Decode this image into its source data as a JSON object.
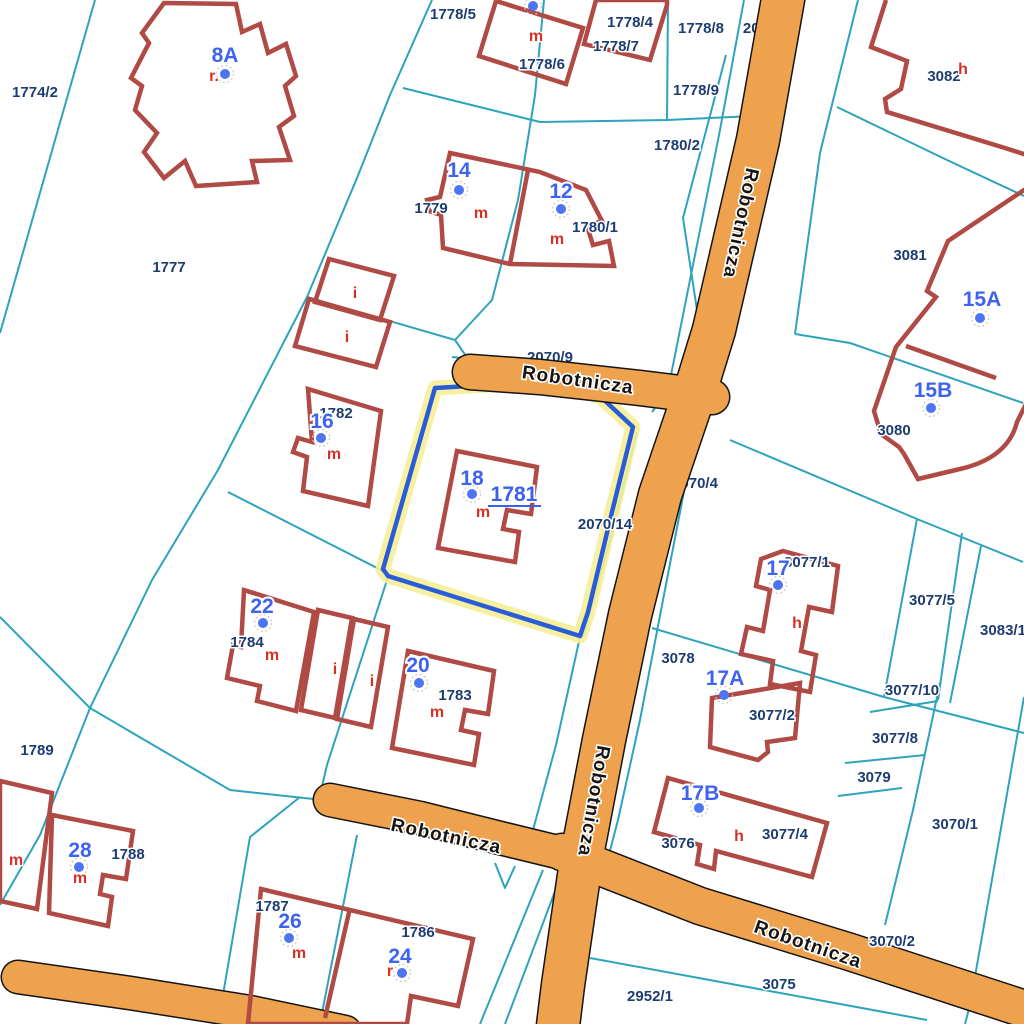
{
  "map": {
    "colors": {
      "background": "#FFFFFF",
      "parcel_line": "#2EA3BC",
      "parcel_label": "#1C3C72",
      "building_outline": "#B04A44",
      "building_number": "#3E63F0",
      "address_point": "#4D74F2",
      "type_letter": "#D53227",
      "road_fill": "#EFA24E",
      "road_casing": "#141414",
      "selection_stroke": "#2B5CD8",
      "selection_halo": "#F5EE96"
    },
    "parcel_lines": [
      [
        95,
        0,
        0,
        333
      ],
      [
        432,
        0,
        390,
        95,
        357,
        178,
        307,
        297
      ],
      [
        403,
        88,
        540,
        122,
        667,
        120,
        753,
        116
      ],
      [
        668,
        0,
        667,
        120
      ],
      [
        726,
        55,
        683,
        218,
        697,
        310
      ],
      [
        307,
        297,
        455,
        340
      ],
      [
        455,
        340,
        492,
        300,
        518,
        200,
        535,
        95,
        544,
        0
      ],
      [
        455,
        340,
        466,
        356
      ],
      [
        307,
        297,
        218,
        470,
        152,
        580,
        90,
        708,
        40,
        835,
        0,
        905
      ],
      [
        0,
        617,
        90,
        708
      ],
      [
        90,
        708,
        230,
        790,
        332,
        801
      ],
      [
        388,
        577,
        327,
        765,
        320,
        795
      ],
      [
        580,
        637,
        556,
        745,
        533,
        830
      ],
      [
        744,
        0,
        720,
        130,
        668,
        390,
        652,
        412
      ],
      [
        858,
        0,
        820,
        153,
        795,
        334
      ],
      [
        795,
        334,
        850,
        343,
        1023,
        403
      ],
      [
        837,
        107,
        947,
        160,
        1024,
        196
      ],
      [
        637,
        432,
        610,
        540,
        583,
        637
      ],
      [
        692,
        450,
        663,
        600,
        640,
        720,
        618,
        820,
        607,
        862
      ],
      [
        730,
        440,
        917,
        519,
        1023,
        562
      ],
      [
        917,
        519,
        884,
        697
      ],
      [
        962,
        533,
        938,
        700
      ],
      [
        981,
        546,
        950,
        703
      ],
      [
        652,
        628,
        884,
        697,
        1024,
        733
      ],
      [
        940,
        683,
        913,
        810,
        885,
        925
      ],
      [
        870,
        712,
        938,
        701
      ],
      [
        845,
        763,
        925,
        755
      ],
      [
        838,
        796,
        902,
        788
      ],
      [
        1024,
        697,
        970,
        1005,
        965,
        1024
      ],
      [
        590,
        958,
        927,
        1020
      ],
      [
        543,
        870,
        480,
        1024
      ],
      [
        560,
        878,
        505,
        1024
      ],
      [
        300,
        797,
        250,
        837,
        218,
        1024
      ],
      [
        357,
        835,
        322,
        1013
      ],
      [
        452,
        357,
        700,
        382
      ],
      [
        333,
        790,
        450,
        812,
        565,
        842
      ],
      [
        495,
        863,
        505,
        888,
        515,
        866
      ],
      [
        228,
        492,
        383,
        571
      ]
    ],
    "roads": {
      "segments": [
        {
          "w": 42,
          "pts": [
            785,
            -12,
            758,
            140,
            714,
            330,
            694,
            395,
            660,
            495,
            630,
            615,
            604,
            740,
            582,
            855,
            563,
            985,
            557,
            1034
          ]
        },
        {
          "w": 34,
          "pts": [
            470,
            372,
            540,
            377,
            640,
            388,
            712,
            397
          ]
        },
        {
          "w": 32,
          "pts": [
            330,
            800,
            420,
            818,
            500,
            838,
            578,
            857
          ]
        },
        {
          "w": 36,
          "pts": [
            562,
            852,
            700,
            906,
            850,
            952,
            1040,
            1014
          ]
        },
        {
          "w": 32,
          "pts": [
            18,
            977,
            130,
            993,
            250,
            1012,
            345,
            1032
          ]
        }
      ],
      "labels": [
        {
          "t": "Robotnicza",
          "x": 577,
          "y": 386,
          "r": 8
        },
        {
          "t": "Robotnicza",
          "x": 735,
          "y": 222,
          "r": 102
        },
        {
          "t": "Robotnicza",
          "x": 588,
          "y": 800,
          "r": 100
        },
        {
          "t": "Robotnicza",
          "x": 445,
          "y": 842,
          "r": 12
        },
        {
          "t": "Robotnicza",
          "x": 806,
          "y": 950,
          "r": 19
        }
      ]
    },
    "selection": {
      "parcel_number": "1781",
      "points": [
        435,
        388,
        558,
        381,
        602,
        398,
        633,
        427,
        612,
        512,
        588,
        612,
        580,
        636,
        388,
        576,
        383,
        569
      ],
      "label": {
        "t": "1781",
        "x": 514,
        "y": 501
      },
      "underline": [
        488,
        506,
        541,
        506
      ]
    },
    "buildings": [
      "M164,3 L142,33 L149,43 L131,78 L142,86 L135,110 L157,133 L144,152 L164,178 L185,161 L196,186 L257,182 L252,161 L290,160 L279,127 L294,116 L285,86 L296,76 L286,44 L268,53 L260,24 L242,32 L236,4 Z",
      "M496,1 L583,28 L566,84 L479,56 Z",
      "M596,0 L584,44 L650,60 L667,5 L667,0 Z",
      "M450,153 L540,172 L586,190 L602,221 L587,226 L593,245 L609,241 L614,266 L510,264 L443,248 L441,215 L429,211 L427,200 L440,197 Z",
      "M329,259 L394,276 L380,320 L315,302 Z",
      "M309,299 L390,322 L376,367 L295,346 Z",
      "M308,389 L381,411 L368,506 L303,491 L307,457 L293,452 L298,438 L312,442 Z",
      "M457,451 L537,467 L531,514 L507,510 L503,529 L519,532 L515,562 L438,548 Z",
      "M244,590 L314,612 L296,711 L257,701 L260,686 L227,678 L233,645 L241,647 Z",
      "M318,610 L352,618 L335,718 L301,710 Z",
      "M354,619 L388,627 L371,727 L337,719 Z",
      "M408,651 L494,671 L488,714 L465,710 L461,730 L479,734 L474,765 L392,748 Z",
      "M0,781 L52,793 L37,909 L0,901 Z",
      "M52,815 L133,831 L126,879 L103,875 L100,894 L112,897 L108,926 L49,913 Z",
      "M261,889 L473,939 L458,1006 L411,996 L407,1024 L248,1024 Z",
      "M886,0 L871,47 L907,61 L901,89 L885,99 L887,112 L1005,148 L1030,156",
      "M1030,186 L948,241 L927,291 L936,297 L896,347 L874,411 L881,434 L899,447 L904,454 L918,479 L960,469 Q1008,458 1017,422 L1030,396",
      "M783,551 L838,566 L832,612 L809,607 L801,651 L816,655 L810,692 L770,684 L773,661 L741,654 L747,627 L763,631 L770,590 L756,586 L761,559 Z",
      "M712,698 L800,683 L795,738 L767,742 L768,752 L758,760 L710,747 Z",
      "M668,778 L827,823 L812,877 L716,851 L714,869 L697,864 L700,845 L654,832 Z"
    ],
    "building_walls": [
      "M528,170 L510,264",
      "M350,908 L325,1018",
      "M906,346 L996,378"
    ],
    "parcel_labels": [
      {
        "t": "1774/2",
        "x": 35,
        "y": 97
      },
      {
        "t": "1777",
        "x": 169,
        "y": 272
      },
      {
        "t": "1778/5",
        "x": 453,
        "y": 19
      },
      {
        "t": "1778/4",
        "x": 630,
        "y": 27
      },
      {
        "t": "1778/8",
        "x": 701,
        "y": 33
      },
      {
        "t": "1778/7",
        "x": 616,
        "y": 51
      },
      {
        "t": "1778/6",
        "x": 542,
        "y": 69
      },
      {
        "t": "1778/9",
        "x": 696,
        "y": 95
      },
      {
        "t": "1780/2",
        "x": 677,
        "y": 150
      },
      {
        "t": "1779",
        "x": 431,
        "y": 213
      },
      {
        "t": "1780/1",
        "x": 595,
        "y": 232
      },
      {
        "t": "3082",
        "x": 944,
        "y": 81
      },
      {
        "t": "3081",
        "x": 910,
        "y": 260
      },
      {
        "t": "3080",
        "x": 894,
        "y": 435
      },
      {
        "t": "1782",
        "x": 336,
        "y": 418
      },
      {
        "t": "2070/14",
        "x": 605,
        "y": 529
      },
      {
        "t": "3077/1",
        "x": 807,
        "y": 567
      },
      {
        "t": "3077/5",
        "x": 932,
        "y": 605
      },
      {
        "t": "3083/1",
        "x": 1003,
        "y": 635
      },
      {
        "t": "3078",
        "x": 678,
        "y": 663
      },
      {
        "t": "3077/10",
        "x": 912,
        "y": 695
      },
      {
        "t": "3077/2",
        "x": 772,
        "y": 720
      },
      {
        "t": "3077/8",
        "x": 895,
        "y": 743
      },
      {
        "t": "3079",
        "x": 874,
        "y": 782
      },
      {
        "t": "3070/1",
        "x": 955,
        "y": 829
      },
      {
        "t": "3076",
        "x": 678,
        "y": 848
      },
      {
        "t": "3077/4",
        "x": 785,
        "y": 839
      },
      {
        "t": "3070/2",
        "x": 892,
        "y": 946
      },
      {
        "t": "3075",
        "x": 779,
        "y": 989
      },
      {
        "t": "2952/1",
        "x": 650,
        "y": 1001
      },
      {
        "t": "1784",
        "x": 247,
        "y": 647
      },
      {
        "t": "1783",
        "x": 455,
        "y": 700
      },
      {
        "t": "1789",
        "x": 37,
        "y": 755
      },
      {
        "t": "1788",
        "x": 128,
        "y": 859
      },
      {
        "t": "1787",
        "x": 272,
        "y": 911
      },
      {
        "t": "1786",
        "x": 418,
        "y": 937
      }
    ],
    "under_road_labels": [
      {
        "t": "2070/9",
        "x": 550,
        "y": 362
      },
      {
        "t": "2070/15",
        "x": 770,
        "y": 33
      },
      {
        "t": "2070/4",
        "x": 695,
        "y": 488
      },
      {
        "t": "2070/10",
        "x": 430,
        "y": 821
      }
    ],
    "building_numbers": [
      {
        "t": "8A",
        "x": 225,
        "y": 62
      },
      {
        "t": "14",
        "x": 459,
        "y": 177
      },
      {
        "t": "12",
        "x": 561,
        "y": 198
      },
      {
        "t": "16",
        "x": 322,
        "y": 428
      },
      {
        "t": "18",
        "x": 472,
        "y": 485
      },
      {
        "t": "22",
        "x": 262,
        "y": 613
      },
      {
        "t": "20",
        "x": 418,
        "y": 672
      },
      {
        "t": "28",
        "x": 80,
        "y": 857
      },
      {
        "t": "26",
        "x": 290,
        "y": 928
      },
      {
        "t": "24",
        "x": 400,
        "y": 963
      },
      {
        "t": "15A",
        "x": 982,
        "y": 306
      },
      {
        "t": "15B",
        "x": 933,
        "y": 397
      },
      {
        "t": "17",
        "x": 778,
        "y": 575
      },
      {
        "t": "17A",
        "x": 725,
        "y": 685
      },
      {
        "t": "17B",
        "x": 700,
        "y": 800
      }
    ],
    "address_points": [
      [
        225,
        74
      ],
      [
        533,
        6
      ],
      [
        459,
        190
      ],
      [
        561,
        209
      ],
      [
        321,
        438
      ],
      [
        472,
        494
      ],
      [
        263,
        623
      ],
      [
        419,
        683
      ],
      [
        79,
        867
      ],
      [
        289,
        938
      ],
      [
        402,
        973
      ],
      [
        980,
        318
      ],
      [
        931,
        408
      ],
      [
        778,
        585
      ],
      [
        724,
        695
      ],
      [
        699,
        808
      ]
    ],
    "type_letters": [
      {
        "t": "r.",
        "x": 214,
        "y": 81
      },
      {
        "t": "m",
        "x": 536,
        "y": 41
      },
      {
        "t": "m",
        "x": 481,
        "y": 218
      },
      {
        "t": "m",
        "x": 557,
        "y": 244
      },
      {
        "t": "i",
        "x": 355,
        "y": 298
      },
      {
        "t": "i",
        "x": 347,
        "y": 342
      },
      {
        "t": "m",
        "x": 334,
        "y": 459
      },
      {
        "t": "m",
        "x": 483,
        "y": 517
      },
      {
        "t": "h",
        "x": 963,
        "y": 74
      },
      {
        "t": "m",
        "x": 272,
        "y": 660
      },
      {
        "t": "i",
        "x": 335,
        "y": 674
      },
      {
        "t": "i",
        "x": 372,
        "y": 686
      },
      {
        "t": "m",
        "x": 437,
        "y": 717
      },
      {
        "t": "h",
        "x": 797,
        "y": 628
      },
      {
        "t": "h",
        "x": 739,
        "y": 841
      },
      {
        "t": "m",
        "x": 16,
        "y": 865
      },
      {
        "t": "m",
        "x": 80,
        "y": 883
      },
      {
        "t": "m",
        "x": 299,
        "y": 958
      },
      {
        "t": "r",
        "x": 390,
        "y": 976
      }
    ]
  }
}
